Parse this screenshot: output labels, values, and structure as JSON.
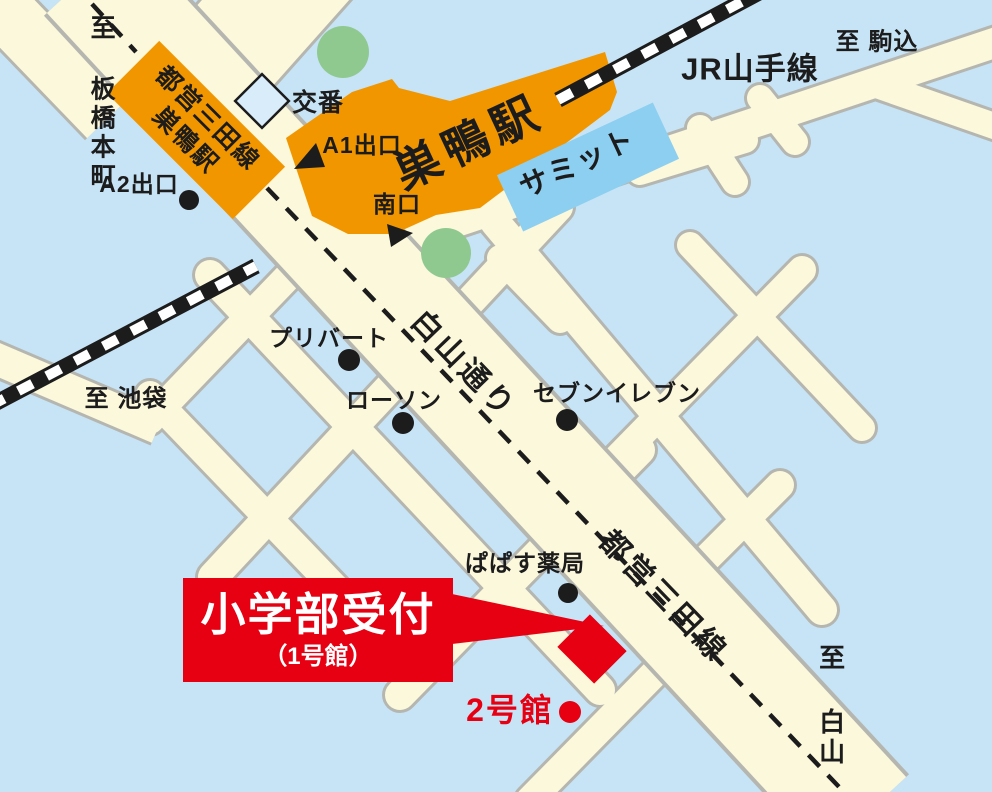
{
  "map": {
    "reception_banner": {
      "title": "小学部受付",
      "subtitle": "（1号館）"
    },
    "station": {
      "name": "巣鴨駅"
    },
    "subway_station_label": {
      "line1": "都営三田線",
      "line2": "巣鴨駅"
    },
    "rail": {
      "jr_line": "JR山手線"
    },
    "roads": {
      "hakusan_dori": "白山通り",
      "mita_line": "都営三田線"
    },
    "directions": {
      "komagome": "至 駒込",
      "itabashi_honcho": "至 板橋本町",
      "ikebukuro": "至 池袋",
      "hakusan": "至 白山"
    },
    "exits": {
      "a1": "A1出口",
      "a2": "A2出口",
      "minami": "南口"
    },
    "pois": {
      "koban": "交番",
      "summit": "サミット",
      "privert": "プリバート",
      "lawson": "ローソン",
      "seven_eleven": "セブンイレブン",
      "papasu_pharmacy": "ぱぱす薬局",
      "building2": "2号館"
    },
    "colors": {
      "background_blue": "#c7e4f6",
      "road_cream": "#fbf8db",
      "road_casing_gray": "#b5b6b0",
      "station_orange": "#f29600",
      "summit_blue": "#8dcff0",
      "tree_green": "#90c98f",
      "accent_red": "#e60012",
      "ink_black": "#1c1c1c",
      "koban_fill": "#d8ecfa"
    }
  }
}
